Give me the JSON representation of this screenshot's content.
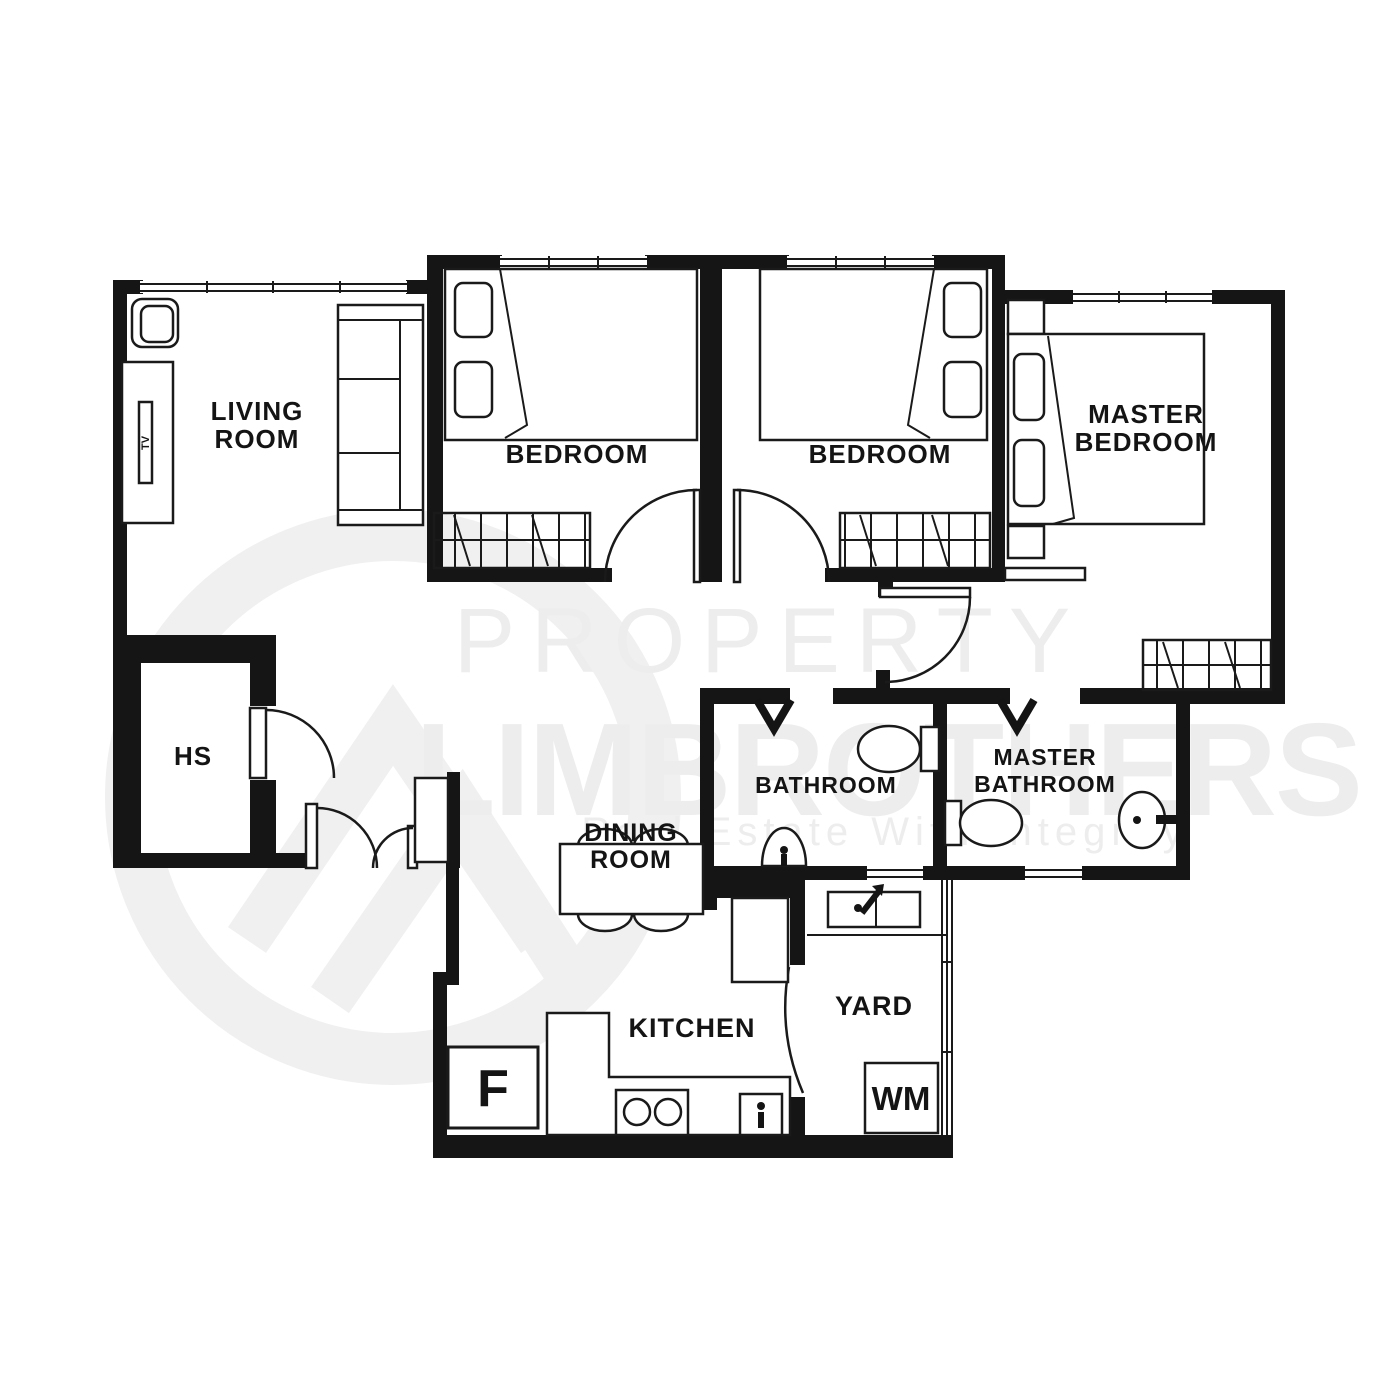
{
  "watermark": {
    "brand_top": "PROPERTY",
    "brand_bottom": "LIMBROTHERS",
    "tagline": "Real Estate With Integrity"
  },
  "rooms": {
    "living_room": {
      "line1": "LIVING",
      "line2": "ROOM"
    },
    "bedroom_left": {
      "label": "BEDROOM"
    },
    "bedroom_right": {
      "label": "BEDROOM"
    },
    "master_bedroom": {
      "line1": "MASTER",
      "line2": "BEDROOM"
    },
    "household_shelter": {
      "label": "HS"
    },
    "bathroom": {
      "label": "BATHROOM"
    },
    "master_bathroom": {
      "line1": "MASTER",
      "line2": "BATHROOM"
    },
    "dining_room": {
      "line1": "DINING",
      "line2": "ROOM"
    },
    "kitchen": {
      "label": "KITCHEN"
    },
    "yard": {
      "label": "YARD"
    }
  },
  "fixtures": {
    "fridge": "F",
    "washing_machine": "WM",
    "tv": "TV"
  },
  "colors": {
    "wall": "#151515",
    "watermark": "#ededed",
    "background": "#ffffff"
  }
}
